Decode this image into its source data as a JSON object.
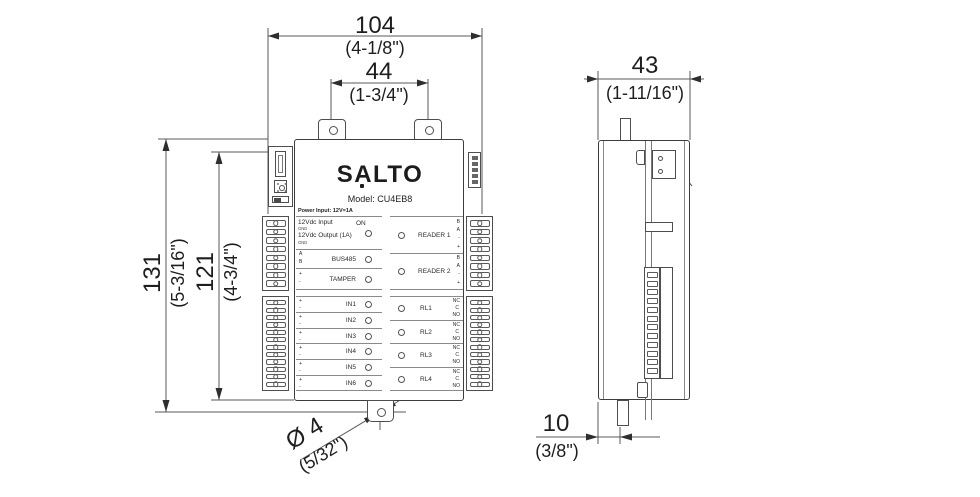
{
  "dimensions": {
    "top_outer_mm": "104",
    "top_outer_in": "(4-1/8\")",
    "top_inner_mm": "44",
    "top_inner_in": "(1-3/4\")",
    "height_outer_mm": "131",
    "height_outer_in": "(5-3/16\")",
    "height_inner_mm": "121",
    "height_inner_in": "(4-3/4\")",
    "hole_mm": "Ø 4",
    "hole_in": "(5/32\")",
    "side_width_mm": "43",
    "side_width_in": "(1-11/16\")",
    "side_offset_mm": "10",
    "side_offset_in": "(3/8\")"
  },
  "front": {
    "logo": "SALTO",
    "model": "Model: CU4EB8",
    "power_heading": "Power Input: 12V=1A",
    "on_label": "ON",
    "power_lines": [
      "12Vdc Input",
      "GND",
      "12Vdc Output (1A)",
      "GND"
    ],
    "bus": {
      "pin_top": "A",
      "pin_bottom": "B",
      "label": "BUS485"
    },
    "tamper": {
      "pin_top": "+",
      "pin_bottom": "-",
      "label": "TAMPER"
    },
    "readers": [
      {
        "label": "READER 1",
        "pins": [
          "B",
          "A",
          "-",
          "+"
        ]
      },
      {
        "label": "READER 2",
        "pins": [
          "B",
          "A",
          "-",
          "+"
        ]
      }
    ],
    "inputs": [
      {
        "pin_top": "+",
        "pin_bottom": "-",
        "label": "IN1"
      },
      {
        "pin_top": "+",
        "pin_bottom": "-",
        "label": "IN2"
      },
      {
        "pin_top": "+",
        "pin_bottom": "-",
        "label": "IN3"
      },
      {
        "pin_top": "+",
        "pin_bottom": "-",
        "label": "IN4"
      },
      {
        "pin_top": "+",
        "pin_bottom": "-",
        "label": "IN5"
      },
      {
        "pin_top": "+",
        "pin_bottom": "-",
        "label": "IN6"
      }
    ],
    "relays": [
      {
        "label": "RL1",
        "pins": [
          "NC",
          "C",
          "NO"
        ]
      },
      {
        "label": "RL2",
        "pins": [
          "NC",
          "C",
          "NO"
        ]
      },
      {
        "label": "RL3",
        "pins": [
          "NC",
          "C",
          "NO"
        ]
      },
      {
        "label": "RL4",
        "pins": [
          "NC",
          "C",
          "NO"
        ]
      }
    ],
    "terminals": {
      "upper_count": 8,
      "lower_count": 12,
      "pin_count": 5
    }
  },
  "side": {
    "cell_count": 12
  }
}
